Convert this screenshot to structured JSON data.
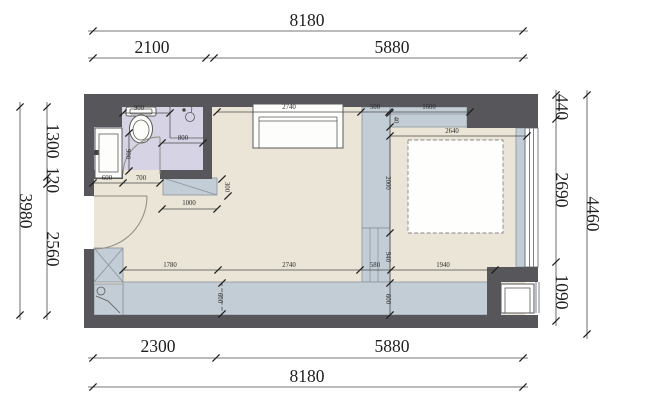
{
  "title": "apartment-floor-plan",
  "colors": {
    "wall": "#57565B",
    "floor": "#EAE5D7",
    "bathroom_floor": "#D6D3E5",
    "cabinet_fill": "#C3CDD5",
    "cabinet_stroke": "#8A939B",
    "dim_color": "#1F1F1F",
    "background": "#FFFFFF"
  },
  "dims": {
    "top_total": "8180",
    "top_seg1": "2100",
    "top_seg2": "5880",
    "bottom_seg1": "2300",
    "bottom_seg2": "5880",
    "bottom_total": "8180",
    "left_seg1": "1300",
    "left_seg2": "120",
    "left_seg3": "2560",
    "left_total": "3980",
    "right_seg1": "440",
    "right_seg2": "2690",
    "right_seg3": "1090",
    "right_total": "4460",
    "sofa_width": "2740",
    "closet_width": "500",
    "headboard_cabinet": "1600",
    "headboard_gap": "40",
    "bed_zone_width": "2640",
    "bed_length": "2000",
    "walkway": "940",
    "bench_depth_right": "600",
    "bench_depth_left": "600",
    "bottom_seg_a": "1780",
    "bottom_seg_b": "2740",
    "bottom_seg_c": "580",
    "bottom_seg_d": "1940",
    "toilet_zone": "900",
    "shower_width": "800",
    "bath_side": "900",
    "vanity_width": "600",
    "bath_door": "700",
    "entry_clearance": "1000",
    "shoe_cabinet_depth": "300"
  }
}
